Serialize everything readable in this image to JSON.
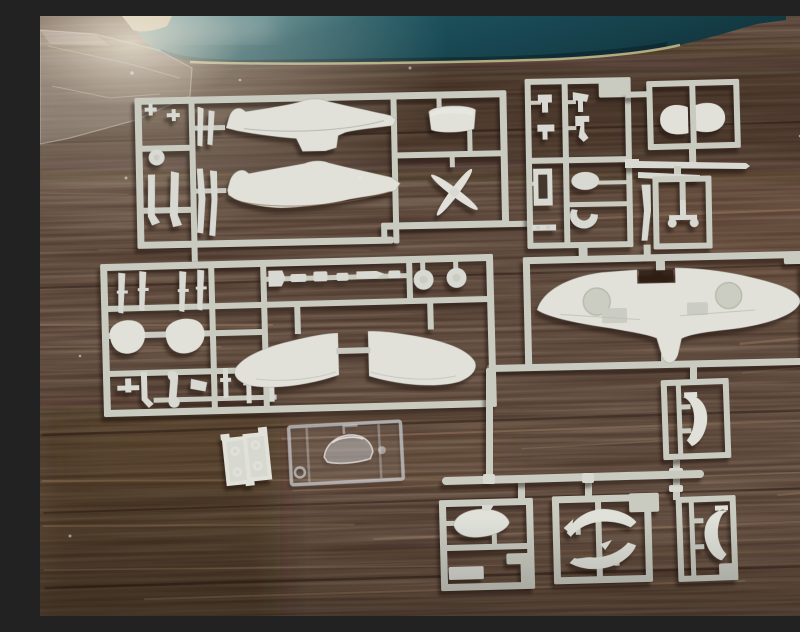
{
  "scene": {
    "description": "Photograph of an aircraft plastic scale-model kit: several light-grey injection-moulded sprues (runners) with parts — fuselage halves, one-piece lower wing, upper wing halves, four-blade propeller, engine cowling, wheels, drop tank, elevators, wheel-well doors, cockpit small parts — plus one clear canopy sprue and a small ring sprue, laid out on a dark brown wood-grain table. A teal box lid sits along the top edge and a clear plastic bag lies at the top-left corner under a bright light reflection.",
    "setting": "dark brown wooden table, slightly diagonal grain, light reflection in upper-left corner"
  },
  "palette": {
    "wood_base": "#503c31",
    "wood_dark": "#2c1c12",
    "wood_light": "#7a5d49",
    "wood_streak": "#caa27a",
    "box_teal": "#1d5a67",
    "box_teal_light": "#4e93a0",
    "box_teal_dark": "#123a44",
    "box_rim": "#cdc492",
    "sprue": "#d7dacf",
    "sprue_bright": "#e6e8df",
    "sprue_shade": "#b9bdb1",
    "part": "#e7e9e1",
    "part_bright": "#f0f2ea",
    "part_shade": "#d9dcd0",
    "beige_runner": "#d5c9a6",
    "tan_item": "#d8cdb0",
    "clear_edge": "rgba(230,238,244,0.65)",
    "bag_fill": "rgba(240,244,246,0.16)",
    "haze": "rgba(255,248,230,0.55)"
  },
  "objects": {
    "box": {
      "label": "teal storage box lid along top edge"
    },
    "bag": {
      "label": "clear plastic parts bag, top-left corner"
    },
    "tan_item": {
      "label": "small tan object at top-left edge"
    },
    "sprues": [
      {
        "id": "A",
        "label": "fuselage sprue (top left)",
        "parts": [
          "upper fuselage half",
          "lower fuselage half",
          "engine cowling",
          "four-blade propeller",
          "small wheel",
          "landing-gear legs",
          "antenna and small fittings"
        ]
      },
      {
        "id": "B",
        "label": "cockpit small-parts sprue (top centre-right)",
        "parts": [
          "seat bracket",
          "instrument pieces",
          "pilot figure parts",
          "radiator frame",
          "oval base",
          "U-shaped bracket"
        ]
      },
      {
        "id": "C",
        "label": "elevator sprue (top right)",
        "parts": [
          "left elevator half",
          "right elevator half"
        ]
      },
      {
        "id": "R1",
        "label": "long tapered rod part below elevator sprue"
      },
      {
        "id": "D",
        "label": "tail-wheel sprue (right, mid-upper)",
        "parts": [
          "tail wheel assembly",
          "thin fairing strip"
        ]
      },
      {
        "id": "E",
        "label": "one-piece lower wing sprue (middle right)",
        "parts": [
          "full-span lower wing with wheel wells and belly fairing"
        ]
      },
      {
        "id": "F",
        "label": "main sprue with upper wing halves (middle left)",
        "parts": [
          "left upper wing half",
          "right upper wing half",
          "two main wheels",
          "two spinner/cover eggs",
          "exhaust and cylinder pieces",
          "gun barrels",
          "struts and pins"
        ]
      },
      {
        "id": "G",
        "label": "small ring sprue (bottom left, white)",
        "parts": [
          "two frames with moulded rings"
        ]
      },
      {
        "id": "H",
        "label": "clear sprue (bottom left, transparent)",
        "parts": [
          "cockpit canopy",
          "small lamp",
          "clear ring"
        ]
      },
      {
        "id": "R2",
        "label": "long runner rod across bottom cluster"
      },
      {
        "id": "I",
        "label": "drop-tank sprue (bottom centre-left)",
        "parts": [
          "slipper drop tank",
          "flat plate"
        ]
      },
      {
        "id": "J",
        "label": "intake sprue (bottom centre)",
        "parts": [
          "carburettor intake blade",
          "radiator housing blade"
        ]
      },
      {
        "id": "K",
        "label": "door sprue upper (bottom right)",
        "parts": [
          "curved wheel-door half"
        ]
      },
      {
        "id": "L",
        "label": "door sprue lower (bottom right)",
        "parts": [
          "curved wheel-door half (mirrored)"
        ]
      }
    ]
  }
}
